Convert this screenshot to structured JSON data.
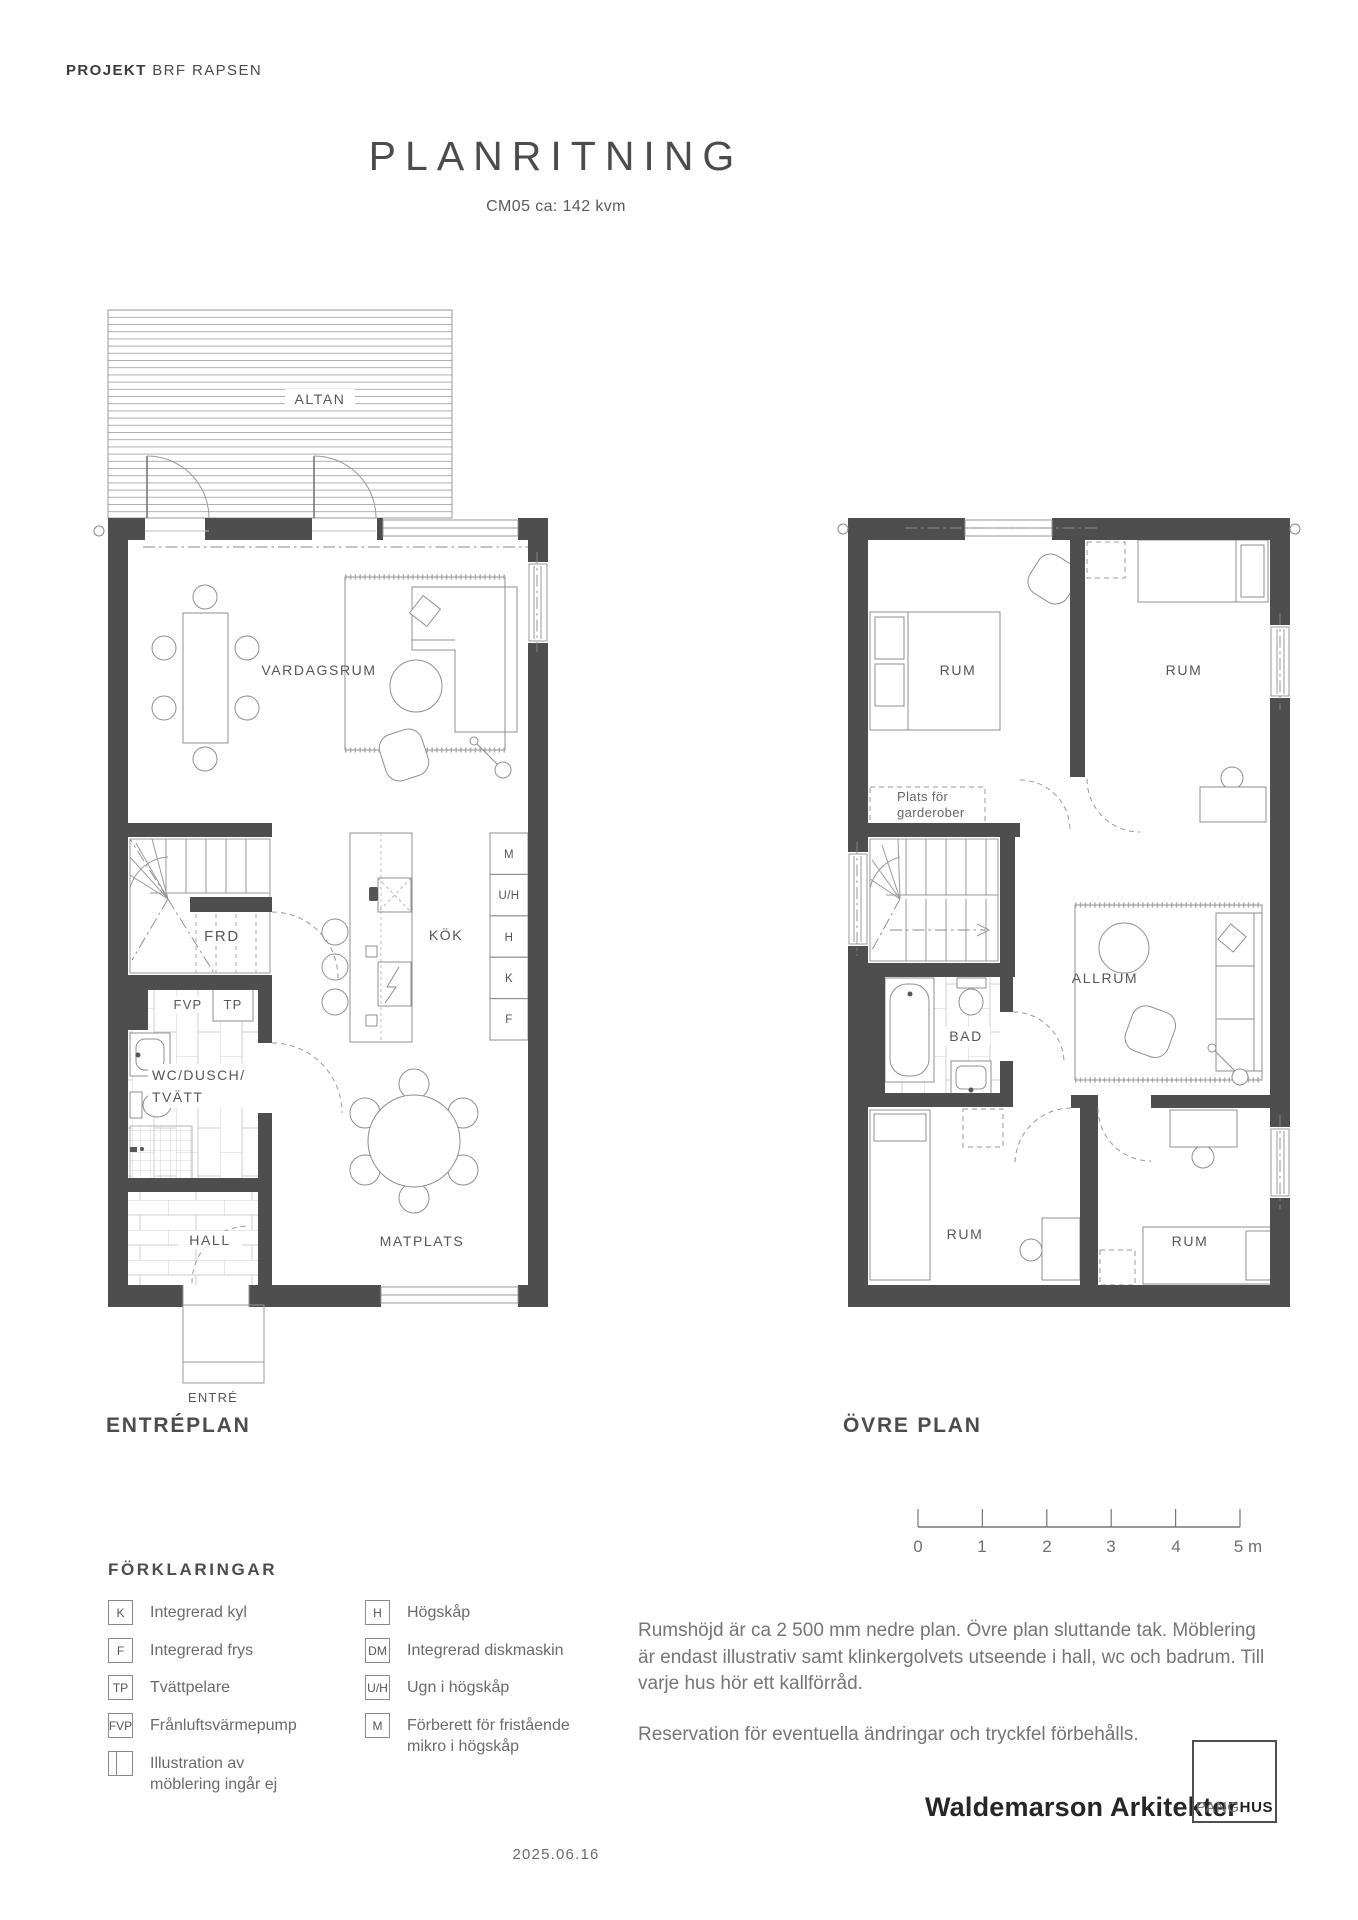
{
  "header": {
    "project_label": "PROJEKT",
    "project_name": "BRF RAPSEN"
  },
  "title": "PLANRITNING",
  "subtitle": "CM05 ca: 142 kvm",
  "plans": {
    "lower": {
      "name": "ENTRÉPLAN",
      "rooms": {
        "altan": "ALTAN",
        "vardagsrum": "VARDAGSRUM",
        "frd": "FRD",
        "fvp": "FVP",
        "tp": "TP",
        "wc_line1": "WC/DUSCH/",
        "wc_line2": "TVÄTT",
        "hall": "HALL",
        "kok": "KÖK",
        "matplats": "MATPLATS",
        "entre": "ENTRÉ"
      },
      "cabinets": [
        "M",
        "U/H",
        "H",
        "K",
        "F"
      ]
    },
    "upper": {
      "name": "ÖVRE PLAN",
      "rooms": {
        "rum": "RUM",
        "plats_line1": "Plats för",
        "plats_line2": "garderober",
        "allrum": "ALLRUM",
        "bad": "BAD"
      }
    }
  },
  "scalebar": {
    "labels": [
      "0",
      "1",
      "2",
      "3",
      "4",
      "5 m"
    ]
  },
  "legend": {
    "heading": "FÖRKLARINGAR",
    "col1": [
      {
        "key": "K",
        "label": "Integrerad kyl"
      },
      {
        "key": "F",
        "label": "Integrerad frys"
      },
      {
        "key": "TP",
        "label": "Tvättpelare"
      },
      {
        "key": "FVP",
        "label": "Frånluftsvärmepump"
      },
      {
        "key": "",
        "label": "Illustration av möblering ingår ej"
      }
    ],
    "col2": [
      {
        "key": "H",
        "label": "Högskåp"
      },
      {
        "key": "DM",
        "label": "Integrerad diskmaskin"
      },
      {
        "key": "U/H",
        "label": "Ugn i högskåp"
      },
      {
        "key": "M",
        "label": "Förberett för fristående mikro i högskåp"
      }
    ]
  },
  "notes": {
    "para1": "Rumshöjd är ca 2 500 mm nedre plan. Övre plan sluttande tak. Möblering är endast illustrativ samt klinkergolvets utseende i hall, wc och badrum. Till varje hus hör ett kallförråd.",
    "para2": "Reservation för eventuella ändringar och tryckfel förbehålls."
  },
  "footer": {
    "architect": "Waldemarson Arkitekter",
    "logo_p": "PANG",
    "logo_h": "HUS",
    "date": "2025.06.16"
  }
}
